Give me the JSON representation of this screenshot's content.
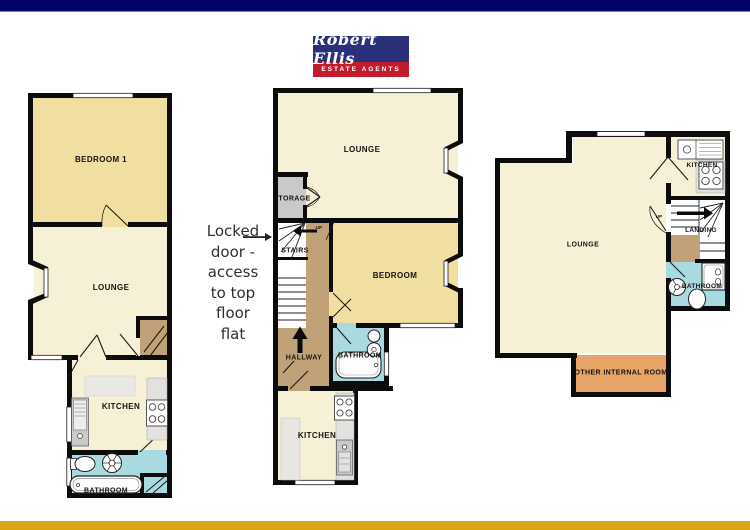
{
  "logo": {
    "name": "Robert Ellis",
    "tagline": "ESTATE AGENTS"
  },
  "annotation": {
    "lines": [
      "Locked",
      "door -",
      "access",
      "to top",
      "floor",
      "flat"
    ]
  },
  "plans": {
    "left": {
      "labels": {
        "bedroom": "BEDROOM 1",
        "lounge": "LOUNGE",
        "kitchen": "KITCHEN",
        "bathroom": "BATHROOM"
      }
    },
    "middle": {
      "labels": {
        "lounge": "LOUNGE",
        "storage": "STORAGE",
        "stairs": "STAIRS",
        "up": "UP",
        "bedroom": "BEDROOM",
        "hallway": "HALLWAY",
        "bathroom": "BATHROOM",
        "kitchen": "KITCHEN"
      }
    },
    "right": {
      "labels": {
        "kitchen": "KITCHEN",
        "up": "UP",
        "landing": "LANDING",
        "lounge": "LOUNGE",
        "bathroom": "BATHROOM",
        "other": "OTHER INTERNAL ROOM"
      }
    }
  },
  "colors": {
    "navy": "#020366",
    "logo-navy": "#2a3079",
    "red": "#c11b30",
    "gold": "#dca313",
    "wall": "#0c0c0c",
    "cream": "#f6f0d6",
    "yellow": "#f1dfa1",
    "blue": "#a9dae0",
    "gray": "#c9c9c9",
    "counter": "#e2e1dd",
    "brown": "#c1a178",
    "orange": "#e7a568",
    "ink": "#141414"
  }
}
